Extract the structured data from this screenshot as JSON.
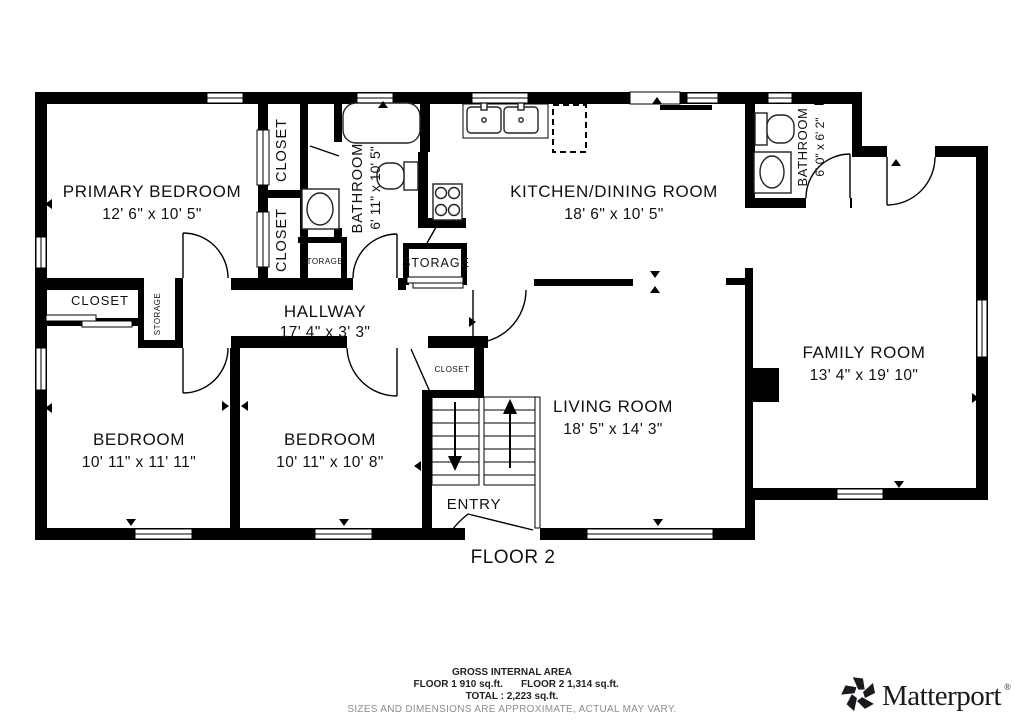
{
  "floor_label": "FLOOR 2",
  "rooms": {
    "primary_bedroom": {
      "name": "PRIMARY BEDROOM",
      "dims": "12' 6\" x 10' 5\""
    },
    "bathroom_main": {
      "name": "BATHROOM",
      "dims": "6' 11\" x 10' 5\""
    },
    "kitchen_dining": {
      "name": "KITCHEN/DINING ROOM",
      "dims": "18' 6\" x 10' 5\""
    },
    "bathroom_small": {
      "name": "BATHROOM",
      "dims": "6' 0\" x 6' 2\""
    },
    "family_room": {
      "name": "FAMILY ROOM",
      "dims": "13' 4\" x 19' 10\""
    },
    "living_room": {
      "name": "LIVING ROOM",
      "dims": "18' 5\" x 14' 3\""
    },
    "hallway": {
      "name": "HALLWAY",
      "dims": "17' 4\" x 3' 3\""
    },
    "bedroom_left": {
      "name": "BEDROOM",
      "dims": "10' 11\" x 11' 11\""
    },
    "bedroom_middle": {
      "name": "BEDROOM",
      "dims": "10' 11\" x 10' 8\""
    },
    "entry": {
      "name": "ENTRY"
    }
  },
  "labels": {
    "closet": "CLOSET",
    "storage": "STORAGE"
  },
  "footer": {
    "heading": "GROSS INTERNAL AREA",
    "floor1": "FLOOR 1 910 sq.ft.",
    "floor2": "FLOOR 2 1,314 sq.ft.",
    "total": "TOTAL : 2,223 sq.ft.",
    "disclaimer": "SIZES AND DIMENSIONS ARE APPROXIMATE, ACTUAL MAY VARY."
  },
  "brand": {
    "wordmark": "Matterport",
    "registered": "®"
  },
  "colors": {
    "wall": "#000000",
    "background": "#ffffff",
    "text": "#111111",
    "muted_text": "#8d8d8d"
  }
}
